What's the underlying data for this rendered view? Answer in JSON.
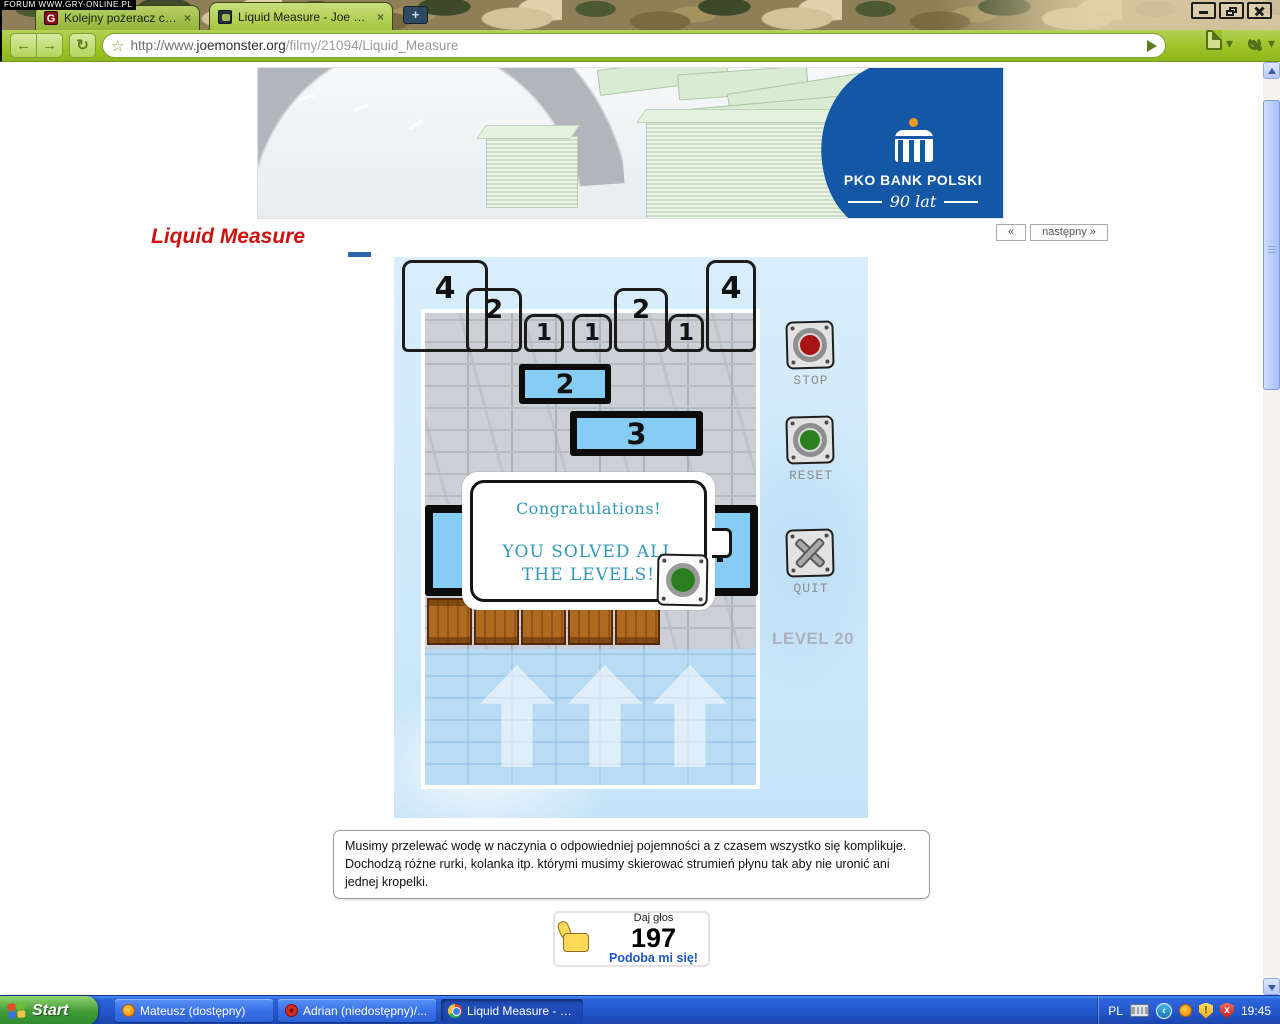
{
  "watermark": "FORUM WWW.GRY-ONLINE.PL",
  "browser": {
    "tab1": {
      "label": "Kolejny pożeracz czasu z j...",
      "close": "×"
    },
    "tab2": {
      "label": "Liquid Measure - Joe Monster",
      "close": "×"
    },
    "new_tab_label": "+",
    "url_scheme": "http://www.",
    "url_domain": "joemonster.org",
    "url_path": "/filmy/21094/Liquid_Measure"
  },
  "icons": {
    "back": "←",
    "forward": "→",
    "reload": "↻",
    "star": "☆",
    "menu_caret": "▾",
    "tray_collapse": "‹",
    "warn": "!",
    "error": "x"
  },
  "banner": {
    "brand": "PKO BANK POLSKI",
    "anniversary": "90 lat"
  },
  "content": {
    "title": "Liquid Measure",
    "prev_label": "«",
    "next_label": "następny »"
  },
  "game": {
    "targets": [
      "4",
      "2",
      "1",
      "1",
      "2",
      "1",
      "4"
    ],
    "tank_small": "2",
    "tank_medium": "3",
    "tank_large": "4",
    "dialog_line1": "Congratulations!",
    "dialog_line2": "YOU SOLVED ALL",
    "dialog_line3": "THE LEVELS!",
    "stop_label": "STOP",
    "reset_label": "RESET",
    "quit_label": "QUIT",
    "level_label": "LEVEL 20"
  },
  "description": "Musimy przelewać wodę w naczynia o odpowiedniej pojemności a z czasem wszystko się komplikuje. Dochodzą różne rurki, kolanka itp. którymi musimy skierować strumień płynu tak aby nie uronić ani jednej kropelki.",
  "vote": {
    "cta": "Daj głos",
    "count": "197",
    "like": "Podoba mi się!"
  },
  "taskbar": {
    "start_label": "Start",
    "tasks": [
      {
        "label": "Mateusz (dostępny)"
      },
      {
        "label": "Adrian (niedostępny)/..."
      },
      {
        "label": "Liquid Measure - Joe ..."
      }
    ],
    "lang": "PL",
    "time": "19:45"
  },
  "colors": {
    "toolbar_green": "#9cc226",
    "taskbar_blue": "#2a5ade",
    "pko_blue": "#1457a5",
    "tank_blue": "#85cdf4",
    "dialog_teal": "#2f98b8",
    "title_red": "#cc1111",
    "like_blue": "#1b57c2",
    "stop_red": "#aa1313",
    "reset_green": "#2b7e1f"
  }
}
